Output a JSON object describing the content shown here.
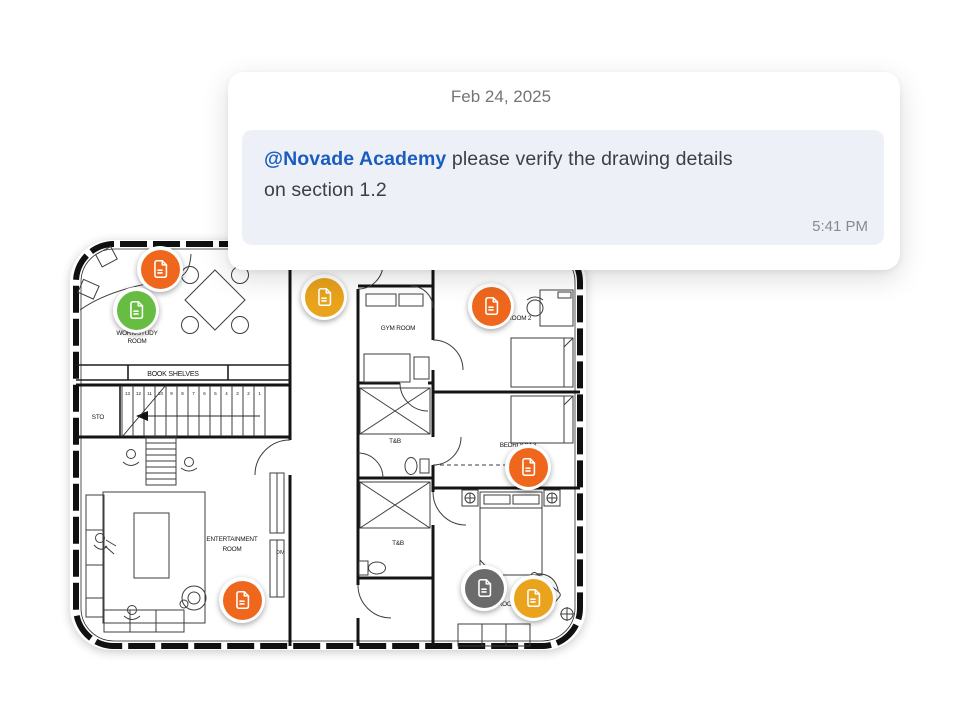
{
  "comment_card": {
    "date": "Feb 24, 2025",
    "message": {
      "mention": "@Novade Academy",
      "line1_rest": " please verify the drawing details",
      "line2": "on section 1.2"
    },
    "timestamp": "5:41 PM",
    "colors": {
      "mention": "#1a5dbe",
      "bubble_bg": "#edf1f7",
      "date_text": "#707579",
      "message_text": "#3c4043",
      "timestamp_text": "#858b90"
    }
  },
  "floorplan": {
    "labels": {
      "work_study_1": "WORK/STUDY",
      "work_study_2": "ROOM",
      "book_shelves": "BOOK SHELVES",
      "sto": "STO",
      "entertainment_1": "ENTERTAINMENT",
      "entertainment_2": "ROOM",
      "div": "DIV",
      "gym": "GYM ROOM",
      "bedroom2": "BEDROOM 2",
      "tb_upper": "T&B",
      "bedroom3": "BEDROOM 3",
      "tb_lower": "T&B",
      "bedroom_master": "BEDROOM"
    },
    "stair_numbers": [
      "13",
      "12",
      "11",
      "10",
      "9",
      "8",
      "7",
      "6",
      "5",
      "4",
      "3",
      "2",
      "1"
    ],
    "markers": [
      {
        "name": "marker-work-study-orange",
        "color": "#ee671d",
        "x": 160,
        "y": 269
      },
      {
        "name": "marker-work-study-green",
        "color": "#67bd41",
        "x": 136,
        "y": 310
      },
      {
        "name": "marker-corridor-amber",
        "color": "#e9a31c",
        "x": 324,
        "y": 297
      },
      {
        "name": "marker-bedroom2-orange",
        "color": "#ee671d",
        "x": 491,
        "y": 306
      },
      {
        "name": "marker-bedroom3-orange",
        "color": "#ee671d",
        "x": 528,
        "y": 467
      },
      {
        "name": "marker-entertainment-orange",
        "color": "#ee671d",
        "x": 242,
        "y": 600
      },
      {
        "name": "marker-bedroom-gray",
        "color": "#6b6b6b",
        "x": 484,
        "y": 588
      },
      {
        "name": "marker-bedroom-amber",
        "color": "#e9a31c",
        "x": 533,
        "y": 598
      }
    ]
  }
}
